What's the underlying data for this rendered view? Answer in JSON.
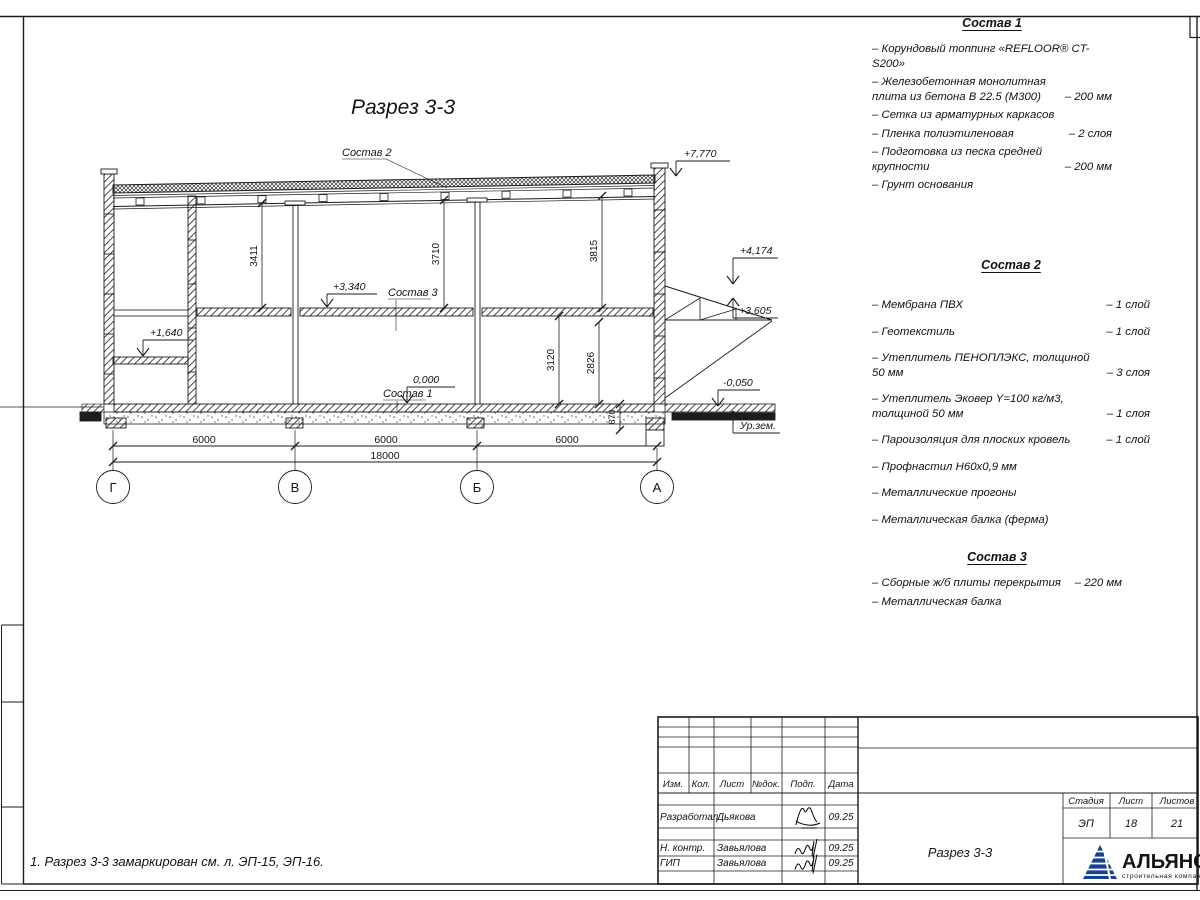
{
  "sheet": {
    "note": "1. Разрез 3-3 замаркирован см. л. ЭП-15, ЭП-16."
  },
  "drawing": {
    "title": "Разрез 3-3",
    "labels": {
      "l1": "Состав 1",
      "l2": "Состав 2",
      "l3": "Состав 3"
    },
    "elevations": {
      "top": "+7,770",
      "canopy_top": "+4,174",
      "canopy_bot": "+3,605",
      "slab": "+3,340",
      "mezz": "+1,640",
      "zero": "0,000",
      "ground": "-0,050",
      "ground_label": "Ур.зем."
    },
    "dims": {
      "h1": "3411",
      "h2": "3710",
      "h3": "3815",
      "h4": "3120",
      "h5": "2826",
      "h6": "670",
      "s1": "6000",
      "s2": "6000",
      "s3": "6000",
      "total": "18000"
    },
    "axes": [
      "Г",
      "В",
      "Б",
      "А"
    ]
  },
  "compositions": [
    {
      "heading": "Состав 1",
      "items": [
        {
          "name": "– Корундовый топпинг «REFLOOR® CT-S200»",
          "value": ""
        },
        {
          "name": "– Железобетонная монолитная плита из бетона В 22.5 (М300)",
          "value": "– 200 мм"
        },
        {
          "name": "– Сетка из арматурных каркасов",
          "value": ""
        },
        {
          "name": "– Пленка полиэтиленовая",
          "value": "– 2 слоя"
        },
        {
          "name": "– Подготовка из песка средней крупности",
          "value": "– 200 мм"
        },
        {
          "name": "– Грунт основания",
          "value": ""
        }
      ]
    },
    {
      "heading": "Состав 2",
      "items": [
        {
          "name": "– Мембрана ПВХ",
          "value": "– 1 слой"
        },
        {
          "name": "– Геотекстиль",
          "value": "– 1 слой"
        },
        {
          "name": "– Утеплитель ПЕНОПЛЭКС, толщиной 50 мм",
          "value": "– 3 слоя"
        },
        {
          "name": "– Утеплитель Эковер Y=100 кг/м3, толщиной 50 мм",
          "value": "– 1 слоя"
        },
        {
          "name": "– Пароизоляция для плоских кровель",
          "value": "– 1 слой"
        },
        {
          "name": "– Профнастил Н60х0,9 мм",
          "value": ""
        },
        {
          "name": "– Металлические прогоны",
          "value": ""
        },
        {
          "name": "– Металлическая балка (ферма)",
          "value": ""
        }
      ]
    },
    {
      "heading": "Состав 3",
      "items": [
        {
          "name": "– Сборные ж/б плиты перекрытия",
          "value": "– 220 мм"
        },
        {
          "name": "– Металлическая балка",
          "value": ""
        }
      ]
    }
  ],
  "stamp": {
    "cols": [
      "Изм.",
      "Кол.",
      "Лист",
      "№док.",
      "Подп.",
      "Дата"
    ],
    "rows": [
      {
        "role": "Разработал",
        "name": "Дьякова",
        "date": "09.25"
      },
      {
        "role": "Н. контр.",
        "name": "Завьялова",
        "date": "09.25"
      },
      {
        "role": "ГИП",
        "name": "Завьялова",
        "date": "09.25"
      }
    ],
    "title": "Разрез 3-3",
    "stage_cols": [
      "Стадия",
      "Лист",
      "Листов"
    ],
    "stage_vals": [
      "ЭП",
      "18",
      "21"
    ],
    "logo": {
      "name": "АЛЬЯНС",
      "tagline": "строительная компания",
      "color": "#17418f",
      "tagline_color": "#4186c6"
    }
  }
}
